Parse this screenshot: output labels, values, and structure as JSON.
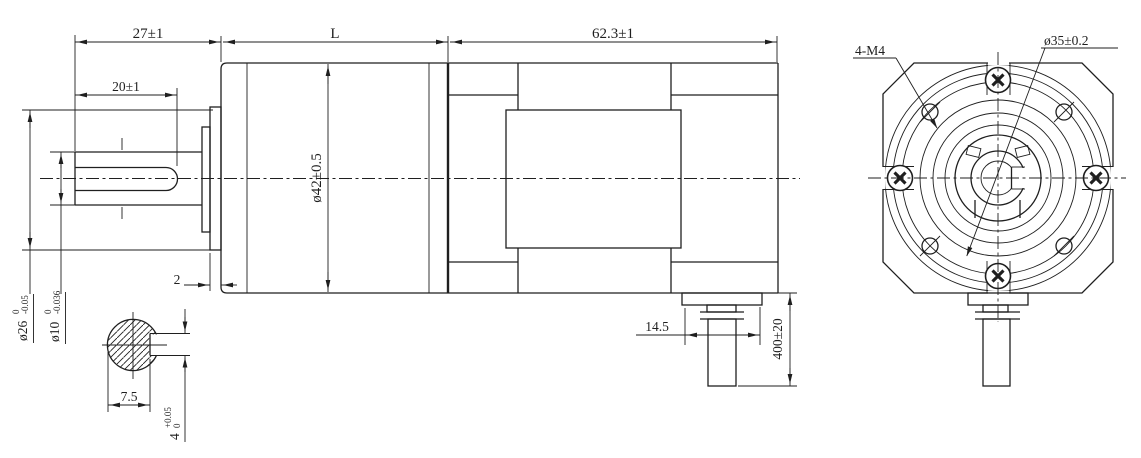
{
  "drawing": {
    "type": "engineering-drawing",
    "views": [
      "side-section-view",
      "front-view"
    ],
    "line_color": "#1f1f1f",
    "background_color": "#ffffff",
    "side_view": {
      "dims": {
        "shaft_extension": "27±1",
        "gearbox_length": "L",
        "motor_length": "62.3±1",
        "flat_length": "20±1",
        "gearbox_diameter": "ø42±0.5",
        "boss_thickness": "2",
        "connector_width": "14.5",
        "cable_length": "400±20",
        "boss_diameter": {
          "nominal": "ø26",
          "tol_upper": "0",
          "tol_lower": "-0.05"
        },
        "shaft_diameter": {
          "nominal": "ø10",
          "tol_upper": "0",
          "tol_lower": "-0.036"
        }
      },
      "section_detail": {
        "flat_width": "7.5",
        "slot_height": {
          "nominal": "4",
          "tol_upper": "+0.05",
          "tol_lower": "0"
        }
      }
    },
    "front_view": {
      "mounting_holes": "4-M4",
      "bolt_circle_diameter": "ø35±0.2"
    }
  }
}
